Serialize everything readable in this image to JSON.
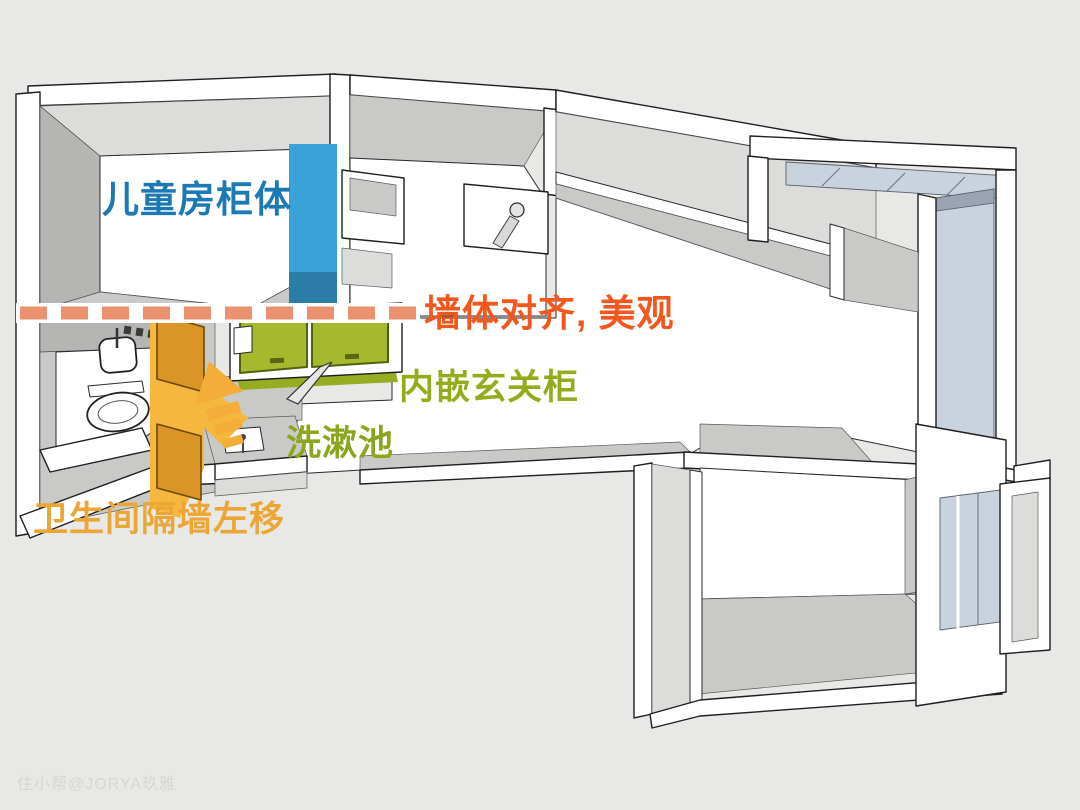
{
  "scene": {
    "type": "3d-floorplan-render",
    "background": "#e8e8e6",
    "description": "SketchUp-style 3D apartment plan with renovation callouts"
  },
  "annotations": {
    "children_cabinet": {
      "text": "儿童房柜体",
      "color": "#1d79b4"
    },
    "wall_align": {
      "text": "墙体对齐, 美观",
      "color": "#f2571d"
    },
    "entry_cabinet": {
      "text": "内嵌玄关柜",
      "color": "#93ac1c"
    },
    "washbasin": {
      "text": "洗漱池",
      "color": "#8ba61c"
    },
    "bathroom_partition": {
      "text": "卫生间隔墙左移",
      "color": "#eca636"
    }
  },
  "watermark": {
    "text": "住小帮@JORYA玖雅",
    "color": "#d6d6d4"
  },
  "highlights": {
    "children_cabinet_fill": "#3aa0d8",
    "children_cabinet_fill_dark": "#2b7ca6",
    "entry_cabinet_fill": "#a6b92e",
    "entry_cabinet_outline": "#51620e",
    "entry_cabinet_shadow": "#96ad22",
    "partition_wall_fill": "#db9526",
    "partition_wall_bright": "#f6b73f",
    "partition_wall_outline": "#6b4a08",
    "arrow_fill": "#f3ad38",
    "dashed_line_color": "#ea9170"
  }
}
